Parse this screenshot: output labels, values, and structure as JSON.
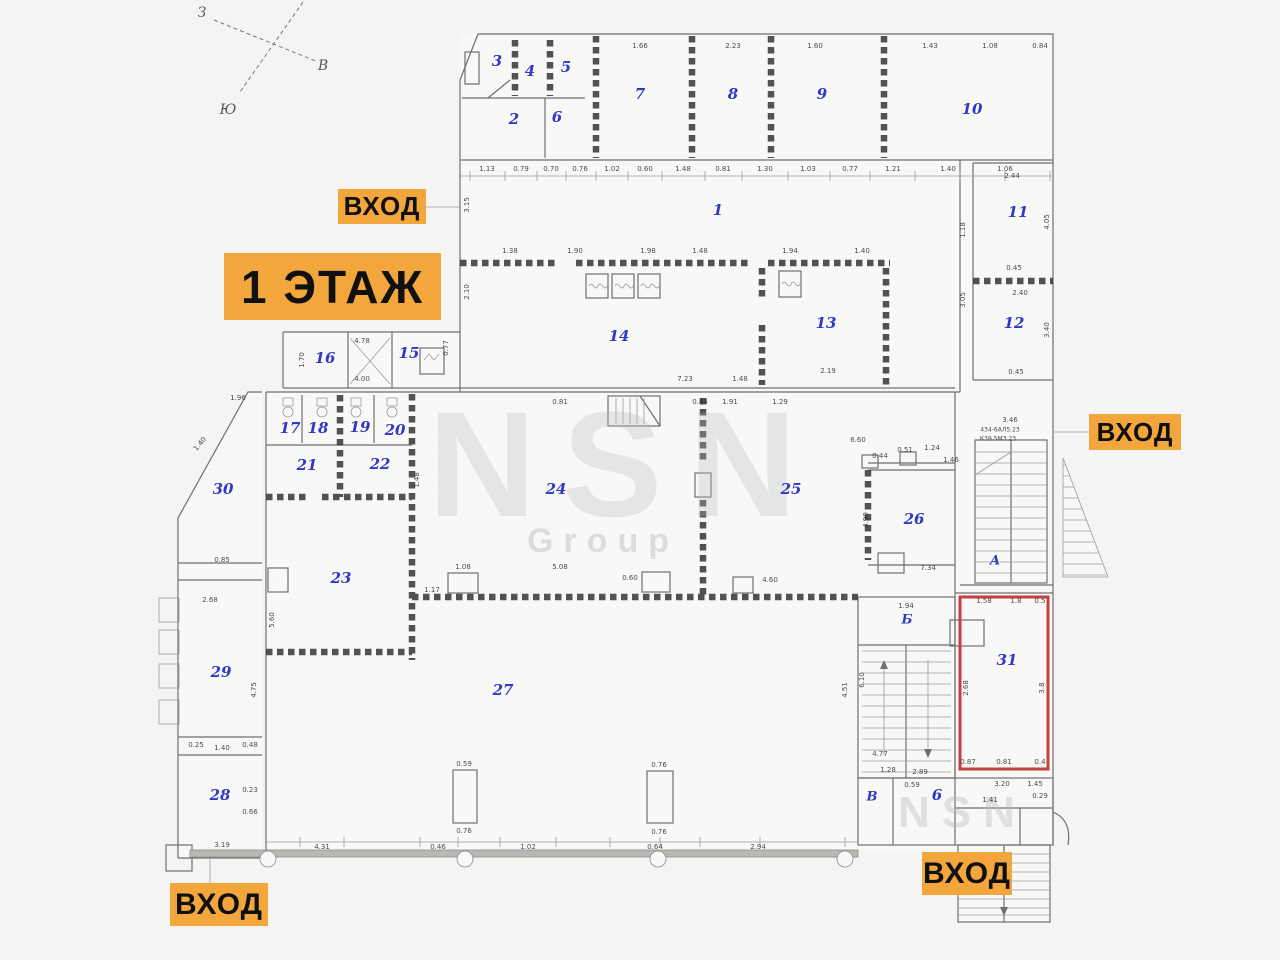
{
  "title": {
    "text": "1 ЭТАЖ"
  },
  "entrances": [
    {
      "text": "ВХОД"
    },
    {
      "text": "ВХОД"
    },
    {
      "text": "ВХОД"
    },
    {
      "text": "ВХОД"
    }
  ],
  "colors": {
    "accent": "#f2a63c",
    "room_number": "#3038c4",
    "highlight_room": "#c64040"
  },
  "watermark": {
    "big": "NSN",
    "sub": "Group",
    "corner": "NSN"
  },
  "compass": {
    "points": [
      {
        "t": "З",
        "x": 202,
        "y": 13
      },
      {
        "t": "В",
        "x": 323,
        "y": 66
      },
      {
        "t": "Ю",
        "x": 228,
        "y": 110
      }
    ]
  },
  "plan": {
    "highlighted_room": "31",
    "room_numbers": [
      {
        "t": "1",
        "x": 718,
        "y": 210
      },
      {
        "t": "2",
        "x": 514,
        "y": 119
      },
      {
        "t": "3",
        "x": 497,
        "y": 61
      },
      {
        "t": "4",
        "x": 530,
        "y": 71
      },
      {
        "t": "5",
        "x": 566,
        "y": 67
      },
      {
        "t": "6",
        "x": 557,
        "y": 117
      },
      {
        "t": "7",
        "x": 640,
        "y": 94
      },
      {
        "t": "8",
        "x": 733,
        "y": 94
      },
      {
        "t": "9",
        "x": 822,
        "y": 94
      },
      {
        "t": "10",
        "x": 972,
        "y": 109
      },
      {
        "t": "11",
        "x": 1018,
        "y": 212
      },
      {
        "t": "12",
        "x": 1014,
        "y": 323
      },
      {
        "t": "13",
        "x": 826,
        "y": 323
      },
      {
        "t": "14",
        "x": 619,
        "y": 336
      },
      {
        "t": "15",
        "x": 409,
        "y": 353
      },
      {
        "t": "16",
        "x": 325,
        "y": 358
      },
      {
        "t": "17",
        "x": 290,
        "y": 428
      },
      {
        "t": "18",
        "x": 318,
        "y": 428
      },
      {
        "t": "19",
        "x": 360,
        "y": 427
      },
      {
        "t": "20",
        "x": 395,
        "y": 430
      },
      {
        "t": "21",
        "x": 307,
        "y": 465
      },
      {
        "t": "22",
        "x": 380,
        "y": 464
      },
      {
        "t": "23",
        "x": 341,
        "y": 578
      },
      {
        "t": "24",
        "x": 556,
        "y": 489
      },
      {
        "t": "25",
        "x": 791,
        "y": 489
      },
      {
        "t": "26",
        "x": 914,
        "y": 519
      },
      {
        "t": "27",
        "x": 503,
        "y": 690
      },
      {
        "t": "28",
        "x": 220,
        "y": 795
      },
      {
        "t": "29",
        "x": 221,
        "y": 672
      },
      {
        "t": "30",
        "x": 223,
        "y": 489
      },
      {
        "t": "31",
        "x": 1007,
        "y": 660
      },
      {
        "t": "6",
        "x": 937,
        "y": 795
      }
    ],
    "section_letters": [
      {
        "t": "А",
        "x": 995,
        "y": 561
      },
      {
        "t": "Б",
        "x": 907,
        "y": 620
      },
      {
        "t": "В",
        "x": 872,
        "y": 797
      }
    ],
    "dimensions": [
      {
        "t": "1.13",
        "x": 487,
        "y": 169
      },
      {
        "t": "0.79",
        "x": 521,
        "y": 169
      },
      {
        "t": "0.70",
        "x": 551,
        "y": 169
      },
      {
        "t": "0.76",
        "x": 580,
        "y": 169
      },
      {
        "t": "1.02",
        "x": 612,
        "y": 169
      },
      {
        "t": "0.60",
        "x": 645,
        "y": 169
      },
      {
        "t": "1.48",
        "x": 683,
        "y": 169
      },
      {
        "t": "0.81",
        "x": 723,
        "y": 169
      },
      {
        "t": "1.30",
        "x": 765,
        "y": 169
      },
      {
        "t": "1.03",
        "x": 808,
        "y": 169
      },
      {
        "t": "0.77",
        "x": 850,
        "y": 169
      },
      {
        "t": "1.21",
        "x": 893,
        "y": 169
      },
      {
        "t": "1.40",
        "x": 948,
        "y": 169
      },
      {
        "t": "1.06",
        "x": 1005,
        "y": 169
      },
      {
        "t": "1.66",
        "x": 640,
        "y": 46
      },
      {
        "t": "2.23",
        "x": 733,
        "y": 46
      },
      {
        "t": "1.60",
        "x": 815,
        "y": 46
      },
      {
        "t": "1.43",
        "x": 930,
        "y": 46
      },
      {
        "t": "1.08",
        "x": 990,
        "y": 46
      },
      {
        "t": "0.84",
        "x": 1040,
        "y": 46
      },
      {
        "t": "1.38",
        "x": 510,
        "y": 251
      },
      {
        "t": "1.90",
        "x": 575,
        "y": 251
      },
      {
        "t": "1.98",
        "x": 648,
        "y": 251
      },
      {
        "t": "1.48",
        "x": 700,
        "y": 251
      },
      {
        "t": "1.94",
        "x": 790,
        "y": 251
      },
      {
        "t": "1.40",
        "x": 862,
        "y": 251
      },
      {
        "t": "7.23",
        "x": 685,
        "y": 379
      },
      {
        "t": "1.48",
        "x": 740,
        "y": 379
      },
      {
        "t": "2.19",
        "x": 828,
        "y": 371
      },
      {
        "t": "1.17",
        "x": 432,
        "y": 590
      },
      {
        "t": "1.08",
        "x": 463,
        "y": 567
      },
      {
        "t": "5.08",
        "x": 560,
        "y": 567
      },
      {
        "t": "0.60",
        "x": 630,
        "y": 578
      },
      {
        "t": "4.60",
        "x": 770,
        "y": 580
      },
      {
        "t": "6.60",
        "x": 858,
        "y": 440
      },
      {
        "t": "4.31",
        "x": 322,
        "y": 847
      },
      {
        "t": "0.46",
        "x": 438,
        "y": 847
      },
      {
        "t": "1.02",
        "x": 528,
        "y": 847
      },
      {
        "t": "0.64",
        "x": 655,
        "y": 847
      },
      {
        "t": "2.94",
        "x": 758,
        "y": 847
      },
      {
        "t": "0.59",
        "x": 464,
        "y": 764
      },
      {
        "t": "0.76",
        "x": 464,
        "y": 831
      },
      {
        "t": "0.76",
        "x": 659,
        "y": 765
      },
      {
        "t": "0.76",
        "x": 659,
        "y": 832
      },
      {
        "t": "1.94",
        "x": 906,
        "y": 606
      },
      {
        "t": "4.77",
        "x": 880,
        "y": 754
      },
      {
        "t": "1.28",
        "x": 888,
        "y": 770
      },
      {
        "t": "2.89",
        "x": 920,
        "y": 772
      },
      {
        "t": "1.58",
        "x": 984,
        "y": 601
      },
      {
        "t": "1.8",
        "x": 1016,
        "y": 601
      },
      {
        "t": "0.5",
        "x": 1040,
        "y": 601
      },
      {
        "t": "0.87",
        "x": 968,
        "y": 762
      },
      {
        "t": "0.81",
        "x": 1004,
        "y": 762
      },
      {
        "t": "0.4",
        "x": 1040,
        "y": 762
      },
      {
        "t": "0.59",
        "x": 912,
        "y": 785
      },
      {
        "t": "3.20",
        "x": 1002,
        "y": 784
      },
      {
        "t": "1.45",
        "x": 1035,
        "y": 784
      },
      {
        "t": "1.41",
        "x": 990,
        "y": 800
      },
      {
        "t": "0.29",
        "x": 1040,
        "y": 796
      },
      {
        "t": "2.44",
        "x": 1012,
        "y": 176
      },
      {
        "t": "0.45",
        "x": 1014,
        "y": 268
      },
      {
        "t": "2.40",
        "x": 1020,
        "y": 293
      },
      {
        "t": "0.45",
        "x": 1016,
        "y": 372
      },
      {
        "t": "3.46",
        "x": 1010,
        "y": 420
      },
      {
        "t": "434-6АЛ5.23",
        "x": 1000,
        "y": 430,
        "fs": 6
      },
      {
        "t": "К39.5М3.23",
        "x": 998,
        "y": 439,
        "fs": 6
      },
      {
        "t": "0.51",
        "x": 905,
        "y": 450
      },
      {
        "t": "1.24",
        "x": 932,
        "y": 448
      },
      {
        "t": "1.46",
        "x": 951,
        "y": 460
      },
      {
        "t": "0.44",
        "x": 880,
        "y": 456
      },
      {
        "t": "7.34",
        "x": 928,
        "y": 568
      },
      {
        "t": "1.96",
        "x": 238,
        "y": 398
      },
      {
        "t": "1.40",
        "x": 200,
        "y": 444,
        "r": -50
      },
      {
        "t": "0.85",
        "x": 222,
        "y": 560
      },
      {
        "t": "2.68",
        "x": 210,
        "y": 600
      },
      {
        "t": "0.25",
        "x": 196,
        "y": 745
      },
      {
        "t": "1.40",
        "x": 222,
        "y": 748
      },
      {
        "t": "0.48",
        "x": 250,
        "y": 745
      },
      {
        "t": "0.23",
        "x": 250,
        "y": 790
      },
      {
        "t": "0.66",
        "x": 250,
        "y": 812
      },
      {
        "t": "3.19",
        "x": 222,
        "y": 845
      },
      {
        "t": "3.15",
        "x": 467,
        "y": 205,
        "r": -90
      },
      {
        "t": "2.10",
        "x": 467,
        "y": 292,
        "r": -90
      },
      {
        "t": "1.18",
        "x": 963,
        "y": 230,
        "r": -90
      },
      {
        "t": "3.05",
        "x": 963,
        "y": 300,
        "r": -90
      },
      {
        "t": "4.05",
        "x": 1047,
        "y": 222,
        "r": -90
      },
      {
        "t": "3.40",
        "x": 1047,
        "y": 330,
        "r": -90
      },
      {
        "t": "4.90",
        "x": 866,
        "y": 520,
        "r": -90
      },
      {
        "t": "5.60",
        "x": 272,
        "y": 620,
        "r": -90
      },
      {
        "t": "4.75",
        "x": 254,
        "y": 690,
        "r": -90
      },
      {
        "t": "1.48",
        "x": 417,
        "y": 480,
        "r": -90
      },
      {
        "t": "2.68",
        "x": 966,
        "y": 688,
        "r": -90
      },
      {
        "t": "3.8",
        "x": 1042,
        "y": 688,
        "r": -90
      },
      {
        "t": "4.51",
        "x": 845,
        "y": 690,
        "r": -90
      },
      {
        "t": "6.10",
        "x": 862,
        "y": 680,
        "r": -90
      },
      {
        "t": "0.81",
        "x": 560,
        "y": 402
      },
      {
        "t": "1.29",
        "x": 780,
        "y": 402
      },
      {
        "t": "1.91",
        "x": 730,
        "y": 402
      },
      {
        "t": "0.44",
        "x": 700,
        "y": 402
      },
      {
        "t": "1.70",
        "x": 302,
        "y": 360,
        "r": -90
      },
      {
        "t": "4.78",
        "x": 362,
        "y": 341
      },
      {
        "t": "4.00",
        "x": 362,
        "y": 379
      },
      {
        "t": "0.77",
        "x": 446,
        "y": 348,
        "r": -90
      }
    ]
  }
}
